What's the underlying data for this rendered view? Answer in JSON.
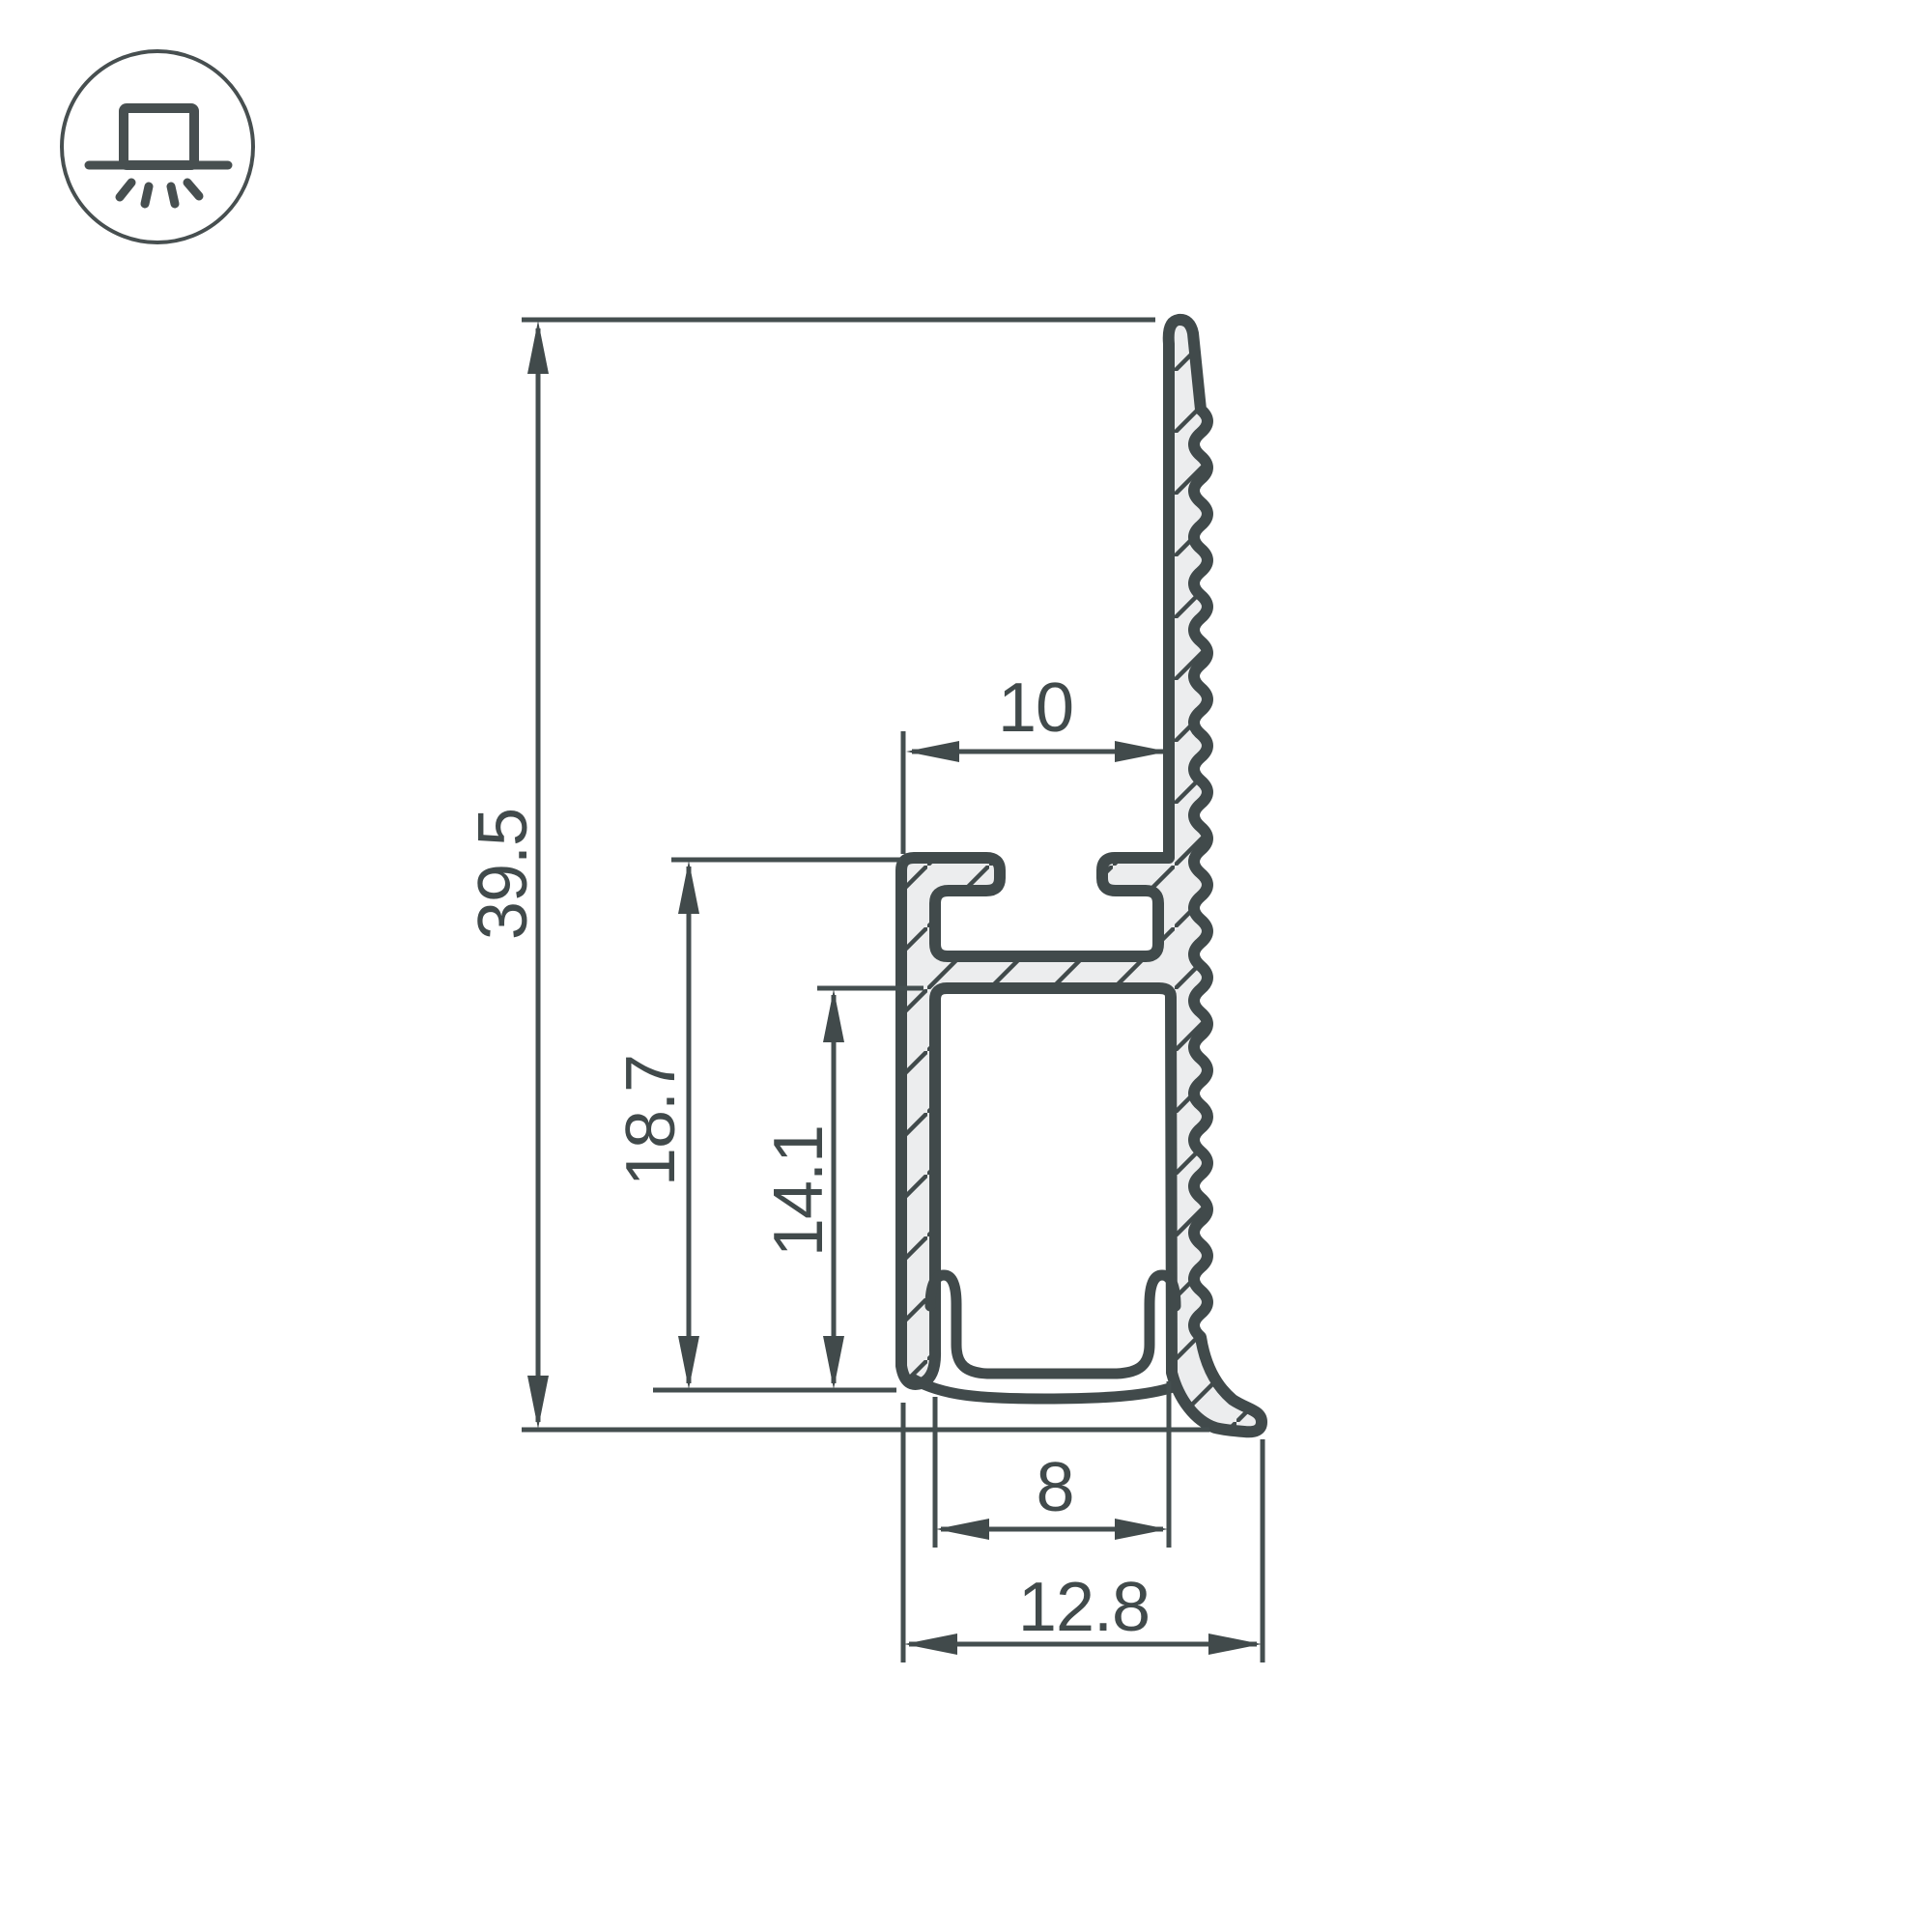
{
  "drawing": {
    "type": "technical-cross-section",
    "subject": "LED profile cross-section with dimensions",
    "unit": "mm",
    "dimensions": {
      "overall_height": "39.5",
      "mount_height": "18.7",
      "channel_inner_height": "14.1",
      "top_groove_width": "10",
      "channel_inner_width": "8",
      "overall_width": "12.8"
    },
    "icon": {
      "name": "surface-mounted-light",
      "description": "circle badge with downlight fixture and rays"
    },
    "colors": {
      "line": "#414a4b",
      "hatch_fill": "#ecedee",
      "background": "#ffffff"
    }
  }
}
